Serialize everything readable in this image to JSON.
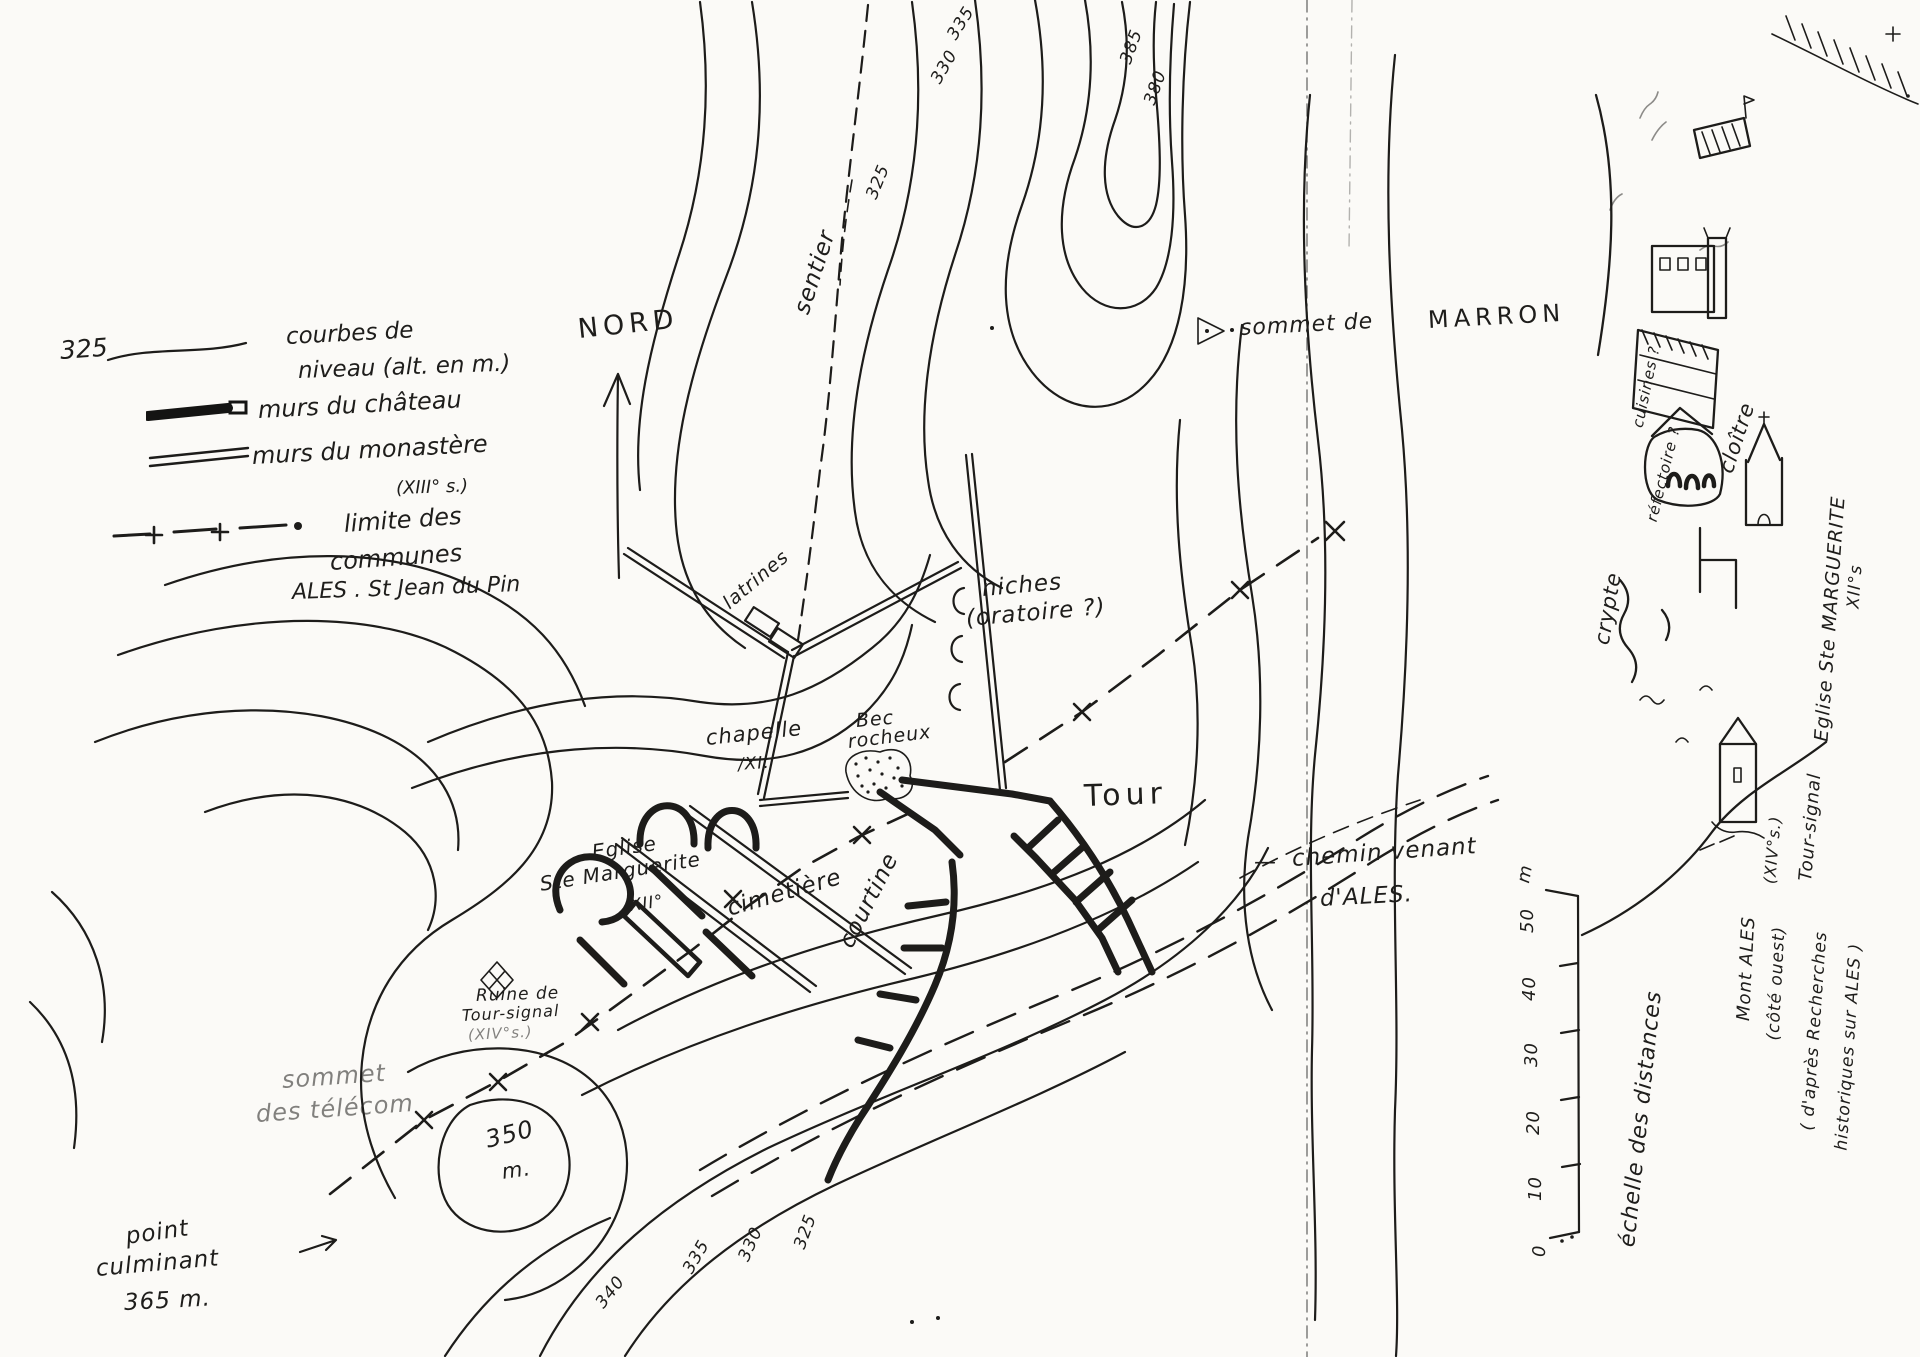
{
  "page": {
    "background": "#fbfaf7",
    "ink": "#1d1c1a"
  },
  "legend": {
    "contour_value": "325",
    "contours_1": "courbes de",
    "contours_2": "niveau (alt. en m.)",
    "chateau": "murs du château",
    "monastere": "murs du monastère",
    "monastere_sub": "(XIII° s.)",
    "limite_1": "limite des",
    "limite_2": "communes",
    "limite_3": "ALES . St Jean du Pin"
  },
  "compass": {
    "label": "NORD"
  },
  "scale": {
    "ticks": [
      "0",
      "10",
      "20",
      "30",
      "40",
      "50"
    ],
    "unit": "m",
    "caption": "échelle des distances"
  },
  "map_labels": [
    {
      "id": "elev-335-top",
      "text": "335",
      "x": 952,
      "y": 30,
      "rot": -58,
      "size": 17,
      "cls": "hw"
    },
    {
      "id": "elev-330-top",
      "text": "330",
      "x": 936,
      "y": 74,
      "rot": -60,
      "size": 17,
      "cls": "hw"
    },
    {
      "id": "elev-325-sentier",
      "text": "325",
      "x": 872,
      "y": 190,
      "rot": -68,
      "size": 17,
      "cls": "hw"
    },
    {
      "id": "elev-385",
      "text": "385",
      "x": 1126,
      "y": 55,
      "rot": -70,
      "size": 17,
      "cls": "hw"
    },
    {
      "id": "elev-380",
      "text": "380",
      "x": 1150,
      "y": 96,
      "rot": -70,
      "size": 17,
      "cls": "hw"
    },
    {
      "id": "sentier-label",
      "text": "sentier",
      "x": 802,
      "y": 302,
      "rot": -72,
      "size": 23,
      "cls": "hw"
    },
    {
      "id": "nord-label",
      "text": "NORD",
      "x": 578,
      "y": 316,
      "rot": -6,
      "size": 27,
      "cls": "print"
    },
    {
      "id": "sommet-de-label",
      "text": "sommet de",
      "x": 1240,
      "y": 318,
      "rot": -3,
      "size": 22,
      "cls": "hw"
    },
    {
      "id": "marron-label",
      "text": "MARRON",
      "x": 1428,
      "y": 308,
      "rot": -3,
      "size": 24,
      "cls": "print"
    },
    {
      "id": "niches-label",
      "text": "niches",
      "x": 982,
      "y": 578,
      "rot": -5,
      "size": 23,
      "cls": "hw"
    },
    {
      "id": "oratoire-label",
      "text": "(oratoire ?)",
      "x": 966,
      "y": 608,
      "rot": -5,
      "size": 23,
      "cls": "hw"
    },
    {
      "id": "latrines-label",
      "text": "latrines",
      "x": 726,
      "y": 596,
      "rot": -40,
      "size": 19,
      "cls": "hw"
    },
    {
      "id": "chapelle-label",
      "text": "chapelle",
      "x": 706,
      "y": 728,
      "rot": -6,
      "size": 21,
      "cls": "hw"
    },
    {
      "id": "chapelle-date",
      "text": "/XI.",
      "x": 738,
      "y": 757,
      "rot": -4,
      "size": 17,
      "cls": "hw"
    },
    {
      "id": "bec-label-1",
      "text": "Bec",
      "x": 856,
      "y": 712,
      "rot": -5,
      "size": 19,
      "cls": "hw"
    },
    {
      "id": "bec-label-2",
      "text": "rocheux",
      "x": 848,
      "y": 733,
      "rot": -7,
      "size": 19,
      "cls": "hw"
    },
    {
      "id": "tour-label",
      "text": "Tour",
      "x": 1084,
      "y": 782,
      "rot": -2,
      "size": 30,
      "cls": "print"
    },
    {
      "id": "eglise-label-1",
      "text": "Eglise",
      "x": 592,
      "y": 842,
      "rot": -8,
      "size": 20,
      "cls": "hw"
    },
    {
      "id": "eglise-label-2",
      "text": "Ste Marguerite",
      "x": 540,
      "y": 874,
      "rot": -9,
      "size": 20,
      "cls": "hw"
    },
    {
      "id": "eglise-label-3",
      "text": "XII°",
      "x": 630,
      "y": 898,
      "rot": -8,
      "size": 17,
      "cls": "hw"
    },
    {
      "id": "cimetiere-label",
      "text": "cimetière",
      "x": 728,
      "y": 898,
      "rot": -16,
      "size": 23,
      "cls": "hw"
    },
    {
      "id": "courtine-label",
      "text": "courtine",
      "x": 846,
      "y": 935,
      "rot": -63,
      "size": 23,
      "cls": "hw"
    },
    {
      "id": "chemin-dash",
      "text": "—",
      "x": 1254,
      "y": 852,
      "rot": 0,
      "size": 22,
      "cls": "hw"
    },
    {
      "id": "chemin-label-1",
      "text": "chemin venant",
      "x": 1292,
      "y": 848,
      "rot": -4,
      "size": 23,
      "cls": "hw"
    },
    {
      "id": "chemin-label-2",
      "text": "d'ALES.",
      "x": 1320,
      "y": 888,
      "rot": -3,
      "size": 23,
      "cls": "hw"
    },
    {
      "id": "ruine-label-1",
      "text": "Ruine de",
      "x": 476,
      "y": 988,
      "rot": -2,
      "size": 17,
      "cls": "hw"
    },
    {
      "id": "ruine-label-2",
      "text": "Tour-signal",
      "x": 462,
      "y": 1008,
      "rot": -3,
      "size": 16,
      "cls": "hw"
    },
    {
      "id": "ruine-label-3",
      "text": "(XIV°s.)",
      "x": 468,
      "y": 1028,
      "rot": -3,
      "size": 15,
      "cls": "hw faint"
    },
    {
      "id": "sommet-telecom-1",
      "text": "sommet",
      "x": 282,
      "y": 1068,
      "rot": -4,
      "size": 24,
      "cls": "hw faint"
    },
    {
      "id": "sommet-telecom-2",
      "text": "des télécom",
      "x": 256,
      "y": 1102,
      "rot": -4,
      "size": 24,
      "cls": "hw faint"
    },
    {
      "id": "elev-350",
      "text": "350",
      "x": 486,
      "y": 1128,
      "rot": -14,
      "size": 24,
      "cls": "hw"
    },
    {
      "id": "elev-350-m",
      "text": "m.",
      "x": 502,
      "y": 1162,
      "rot": -8,
      "size": 21,
      "cls": "hw"
    },
    {
      "id": "point-culminant-1",
      "text": "point",
      "x": 126,
      "y": 1226,
      "rot": -8,
      "size": 23,
      "cls": "hw"
    },
    {
      "id": "point-culminant-2",
      "text": "culminant",
      "x": 96,
      "y": 1258,
      "rot": -5,
      "size": 23,
      "cls": "hw"
    },
    {
      "id": "point-culminant-3",
      "text": "365 m.",
      "x": 124,
      "y": 1292,
      "rot": -3,
      "size": 23,
      "cls": "hw"
    },
    {
      "id": "elev-340-s",
      "text": "340",
      "x": 600,
      "y": 1298,
      "rot": -52,
      "size": 17,
      "cls": "hw"
    },
    {
      "id": "elev-335-s",
      "text": "335",
      "x": 688,
      "y": 1264,
      "rot": -60,
      "size": 17,
      "cls": "hw"
    },
    {
      "id": "elev-330-s",
      "text": "330",
      "x": 744,
      "y": 1252,
      "rot": -66,
      "size": 17,
      "cls": "hw"
    },
    {
      "id": "elev-325-s",
      "text": "325",
      "x": 800,
      "y": 1240,
      "rot": -70,
      "size": 17,
      "cls": "hw"
    },
    {
      "id": "cuisines-label",
      "text": "cuisines ?",
      "x": 1638,
      "y": 420,
      "rot": -78,
      "size": 15,
      "cls": "hw"
    },
    {
      "id": "refectoire-label",
      "text": "réfectoire ?",
      "x": 1652,
      "y": 514,
      "rot": -76,
      "size": 15,
      "cls": "hw"
    },
    {
      "id": "cloitre-label",
      "text": "cloître",
      "x": 1726,
      "y": 462,
      "rot": -72,
      "size": 21,
      "cls": "hw"
    },
    {
      "id": "crypte-label",
      "text": "crypte",
      "x": 1602,
      "y": 634,
      "rot": -80,
      "size": 21,
      "cls": "hw"
    },
    {
      "id": "eglise-marguerite-panel-1",
      "text": "Eglise Ste MARGUERITE",
      "x": 1822,
      "y": 732,
      "rot": -86,
      "size": 19,
      "cls": "hw"
    },
    {
      "id": "eglise-marguerite-panel-2",
      "text": "XII°s",
      "x": 1854,
      "y": 600,
      "rot": -86,
      "size": 17,
      "cls": "hw"
    },
    {
      "id": "tour-signal-panel-1",
      "text": "Tour-signal",
      "x": 1806,
      "y": 872,
      "rot": -85,
      "size": 18,
      "cls": "hw"
    },
    {
      "id": "tour-signal-panel-2",
      "text": "(XIV°s.)",
      "x": 1770,
      "y": 876,
      "rot": -85,
      "size": 16,
      "cls": "hw"
    },
    {
      "id": "mont-ales-1",
      "text": "Mont ALES",
      "x": 1744,
      "y": 1012,
      "rot": -87,
      "size": 18,
      "cls": "hw"
    },
    {
      "id": "mont-ales-2",
      "text": "(côté ouest)",
      "x": 1774,
      "y": 1032,
      "rot": -87,
      "size": 17,
      "cls": "hw"
    },
    {
      "id": "dapres-1",
      "text": "( d'après Recherches",
      "x": 1808,
      "y": 1122,
      "rot": -86,
      "size": 17,
      "cls": "hw"
    },
    {
      "id": "dapres-2",
      "text": "historiques sur ALES )",
      "x": 1842,
      "y": 1142,
      "rot": -86,
      "size": 17,
      "cls": "hw"
    },
    {
      "id": "scale-0",
      "text": "0",
      "x": 1540,
      "y": 1248,
      "rot": -90,
      "size": 18,
      "cls": "hw"
    },
    {
      "id": "scale-10",
      "text": "10",
      "x": 1536,
      "y": 1192,
      "rot": -90,
      "size": 18,
      "cls": "hw"
    },
    {
      "id": "scale-20",
      "text": "20",
      "x": 1534,
      "y": 1126,
      "rot": -90,
      "size": 18,
      "cls": "hw"
    },
    {
      "id": "scale-30",
      "text": "30",
      "x": 1532,
      "y": 1058,
      "rot": -90,
      "size": 18,
      "cls": "hw"
    },
    {
      "id": "scale-40",
      "text": "40",
      "x": 1530,
      "y": 992,
      "rot": -90,
      "size": 18,
      "cls": "hw"
    },
    {
      "id": "scale-50",
      "text": "50",
      "x": 1528,
      "y": 924,
      "rot": -90,
      "size": 18,
      "cls": "hw"
    },
    {
      "id": "scale-unit",
      "text": "m",
      "x": 1524,
      "y": 874,
      "rot": -80,
      "size": 18,
      "cls": "hw"
    },
    {
      "id": "scale-caption",
      "text": "échelle des distances",
      "x": 1628,
      "y": 1236,
      "rot": -84,
      "size": 22,
      "cls": "hw"
    }
  ]
}
